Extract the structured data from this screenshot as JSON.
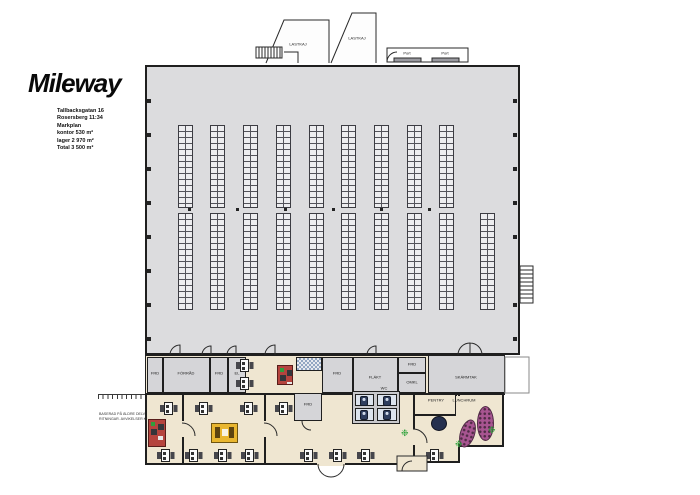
{
  "header": {
    "logo": "Mileway",
    "address_lines": [
      "Tallbacksgatan 16",
      "Rosersberg 11:34",
      "Markplan",
      "kontor 530 m²",
      "lager 2 970 m²",
      "Total 3 500 m²"
    ]
  },
  "plan": {
    "labels": {
      "lastkaj": "LASTKAJ",
      "port": "Port",
      "frd": "FRD",
      "forrad": "FÖRRÅD",
      "el": "EL",
      "flakt": "FLÄKT",
      "omkl": "OMKL",
      "skarmtak": "SKÄRMTAK",
      "wc": "WC",
      "pentry": "PENTRY",
      "lunchrum": "LUNCHRUM"
    }
  },
  "footer": {
    "disclaimer_line1": "BASERAD PÅ ÄLDRE DELVIS MÅTTSATTA",
    "disclaimer_line2": "RITNINGAR. AVVIKELSER KAN FÖREKOMMA"
  },
  "colors": {
    "warehouse_fill": "#dcdcde",
    "office_fill": "#efe6d1",
    "wall": "#1f1f1f",
    "accent_red": "#b5443e",
    "accent_yellow": "#e9b62f",
    "accent_purple": "#a85591",
    "accent_navy": "#25304f",
    "accent_green": "#2fa23b"
  }
}
